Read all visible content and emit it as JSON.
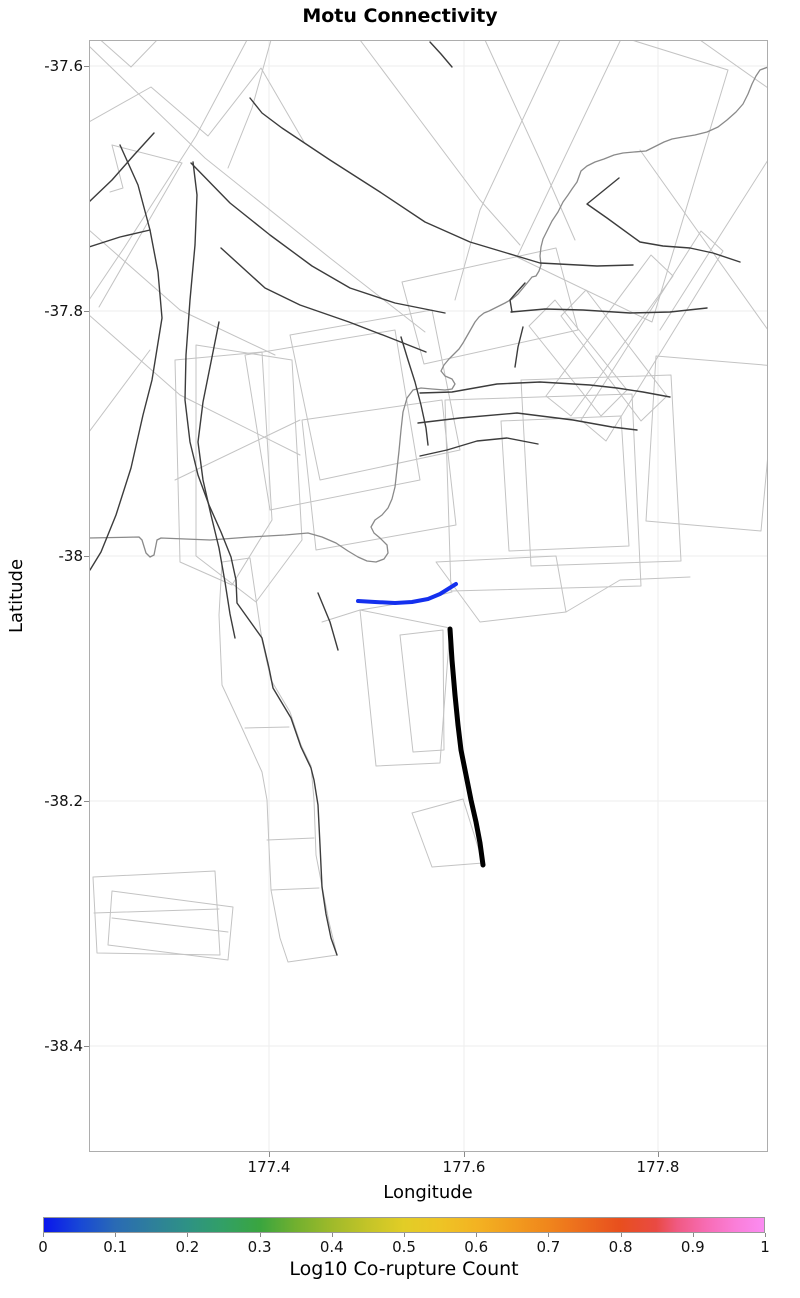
{
  "title": "Motu Connectivity",
  "axes": {
    "xlabel": "Longitude",
    "ylabel": "Latitude",
    "x_ticks": [
      {
        "label": "177.4",
        "px": 269
      },
      {
        "label": "177.6",
        "px": 464
      },
      {
        "label": "177.8",
        "px": 658
      }
    ],
    "y_ticks": [
      {
        "label": "-37.6",
        "px": 66
      },
      {
        "label": "-37.8",
        "px": 311
      },
      {
        "label": "-38",
        "px": 556
      },
      {
        "label": "-38.2",
        "px": 801
      },
      {
        "label": "-38.4",
        "px": 1046
      }
    ]
  },
  "colorbar": {
    "label": "Log10 Co-rupture Count",
    "tick_labels": [
      "0",
      "0.1",
      "0.2",
      "0.3",
      "0.4",
      "0.5",
      "0.6",
      "0.7",
      "0.8",
      "0.9",
      "1"
    ],
    "tick_fractions": [
      0,
      0.1,
      0.2,
      0.3,
      0.4,
      0.5,
      0.6,
      0.7,
      0.8,
      0.9,
      1
    ],
    "range": [
      0,
      1
    ],
    "gradient_stops": [
      {
        "f": 0.0,
        "c": "#0a16ec"
      },
      {
        "f": 0.05,
        "c": "#1848d6"
      },
      {
        "f": 0.1,
        "c": "#2a6bb4"
      },
      {
        "f": 0.15,
        "c": "#2e7f9b"
      },
      {
        "f": 0.2,
        "c": "#2e9284"
      },
      {
        "f": 0.25,
        "c": "#32a065"
      },
      {
        "f": 0.3,
        "c": "#3aa53f"
      },
      {
        "f": 0.35,
        "c": "#72b02f"
      },
      {
        "f": 0.4,
        "c": "#9fba2a"
      },
      {
        "f": 0.45,
        "c": "#c4c428"
      },
      {
        "f": 0.5,
        "c": "#e2cd26"
      },
      {
        "f": 0.55,
        "c": "#eec425"
      },
      {
        "f": 0.6,
        "c": "#f3b322"
      },
      {
        "f": 0.65,
        "c": "#f29d1e"
      },
      {
        "f": 0.7,
        "c": "#f0861c"
      },
      {
        "f": 0.75,
        "c": "#ec6a1d"
      },
      {
        "f": 0.8,
        "c": "#e84f1e"
      },
      {
        "f": 0.85,
        "c": "#e94a43"
      },
      {
        "f": 0.88,
        "c": "#f05a83"
      },
      {
        "f": 0.92,
        "c": "#f76cb4"
      },
      {
        "f": 0.96,
        "c": "#fa7ed8"
      },
      {
        "f": 1.0,
        "c": "#fb8cf2"
      }
    ]
  },
  "chart_data": {
    "type": "map",
    "title": "Motu Connectivity",
    "xlabel": "Longitude",
    "ylabel": "Latitude",
    "lon_range": [
      177.22,
      177.91
    ],
    "lat_range": [
      -38.49,
      -37.58
    ],
    "grid": true,
    "plot_px": {
      "left": 89,
      "top": 40,
      "width": 679,
      "height": 1112
    },
    "calibration": {
      "lon_177_4_px": 269,
      "lon_177_6_px": 464,
      "lat_m37_6_px": 66,
      "lat_m38_px": 556
    },
    "styles": {
      "polygon": {
        "stroke": "#c3c3c3",
        "width": 1.0
      },
      "faint": {
        "stroke": "#c3c3c3",
        "width": 1.0
      },
      "coast": {
        "stroke": "#8a8a8a",
        "width": 1.3
      },
      "trace": {
        "stroke": "#3c3c3c",
        "width": 1.4
      },
      "highlight_min": {
        "stroke": "#1430ee",
        "width": 4.0
      },
      "highlight_bold": {
        "stroke": "#000000",
        "width": 5.0
      }
    },
    "gridline_color": "#ededed",
    "polygons": [
      [
        622,
        37,
        728,
        70,
        652,
        322,
        517,
        257
      ],
      [
        175,
        360,
        262,
        352,
        272,
        520,
        232,
        585,
        180,
        562
      ],
      [
        196,
        345,
        292,
        360,
        302,
        540,
        256,
        602,
        196,
        556
      ],
      [
        245,
        355,
        395,
        330,
        420,
        480,
        270,
        510
      ],
      [
        290,
        335,
        432,
        310,
        460,
        450,
        320,
        480
      ],
      [
        302,
        420,
        442,
        400,
        456,
        525,
        316,
        550
      ],
      [
        555,
        300,
        627,
        390,
        601,
        416,
        529,
        326
      ],
      [
        586,
        290,
        667,
        396,
        641,
        421,
        561,
        316
      ],
      [
        651,
        255,
        546,
        396,
        571,
        416,
        673,
        276
      ],
      [
        701,
        231,
        581,
        420,
        606,
        441,
        723,
        251
      ],
      [
        445,
        400,
        632,
        394,
        641,
        586,
        451,
        591
      ],
      [
        521,
        380,
        671,
        375,
        681,
        561,
        531,
        566
      ],
      [
        501,
        421,
        621,
        416,
        629,
        546,
        509,
        551
      ],
      [
        656,
        356,
        776,
        366,
        761,
        531,
        646,
        521
      ],
      [
        402,
        282,
        556,
        248,
        578,
        330,
        424,
        364
      ],
      [
        360,
        610,
        450,
        628,
        440,
        763,
        376,
        766
      ],
      [
        400,
        635,
        443,
        630,
        444,
        750,
        413,
        752
      ],
      [
        412,
        813,
        463,
        799,
        483,
        863,
        432,
        867
      ],
      [
        93,
        877,
        215,
        871,
        220,
        955,
        97,
        953
      ],
      [
        112,
        891,
        233,
        907,
        228,
        960,
        108,
        945
      ],
      [
        222,
        562,
        250,
        558,
        262,
        640,
        271,
        680,
        290,
        712,
        301,
        745,
        311,
        766,
        314,
        800,
        316,
        855,
        329,
        922,
        337,
        955,
        288,
        962,
        280,
        938,
        271,
        890,
        269,
        847,
        267,
        800,
        262,
        772,
        242,
        728,
        222,
        685,
        219,
        615
      ],
      [
        436,
        562,
        556,
        556,
        566,
        612,
        480,
        622
      ]
    ],
    "faint_lines": [
      [
        96,
        36,
        131,
        67,
        215,
        -20
      ],
      [
        89,
        122,
        151,
        87,
        208,
        136,
        261,
        68,
        304,
        142
      ],
      [
        89,
        46,
        205,
        158,
        330,
        258,
        425,
        332
      ],
      [
        247,
        40,
        196,
        136,
        124,
        248,
        89,
        300
      ],
      [
        271,
        40,
        252,
        108,
        228,
        168
      ],
      [
        360,
        40,
        420,
        120,
        480,
        200,
        520,
        245
      ],
      [
        560,
        40,
        480,
        210,
        455,
        300
      ],
      [
        89,
        315,
        180,
        395,
        300,
        455
      ],
      [
        89,
        432,
        150,
        350
      ],
      [
        175,
        480,
        300,
        420
      ],
      [
        700,
        40,
        768,
        88
      ],
      [
        640,
        150,
        768,
        330
      ],
      [
        768,
        160,
        660,
        330
      ],
      [
        485,
        40,
        540,
        160,
        575,
        240
      ],
      [
        94,
        913,
        219,
        909
      ],
      [
        112,
        918,
        228,
        932
      ],
      [
        245,
        728,
        289,
        727
      ],
      [
        267,
        840,
        314,
        838
      ],
      [
        271,
        890,
        319,
        888
      ],
      [
        322,
        622,
        360,
        610,
        420,
        600,
        452,
        592
      ],
      [
        566,
        612,
        620,
        580,
        690,
        577
      ],
      [
        112,
        145,
        182,
        163
      ],
      [
        112,
        145,
        123,
        188,
        110,
        192
      ],
      [
        182,
        163,
        99,
        307
      ],
      [
        89,
        230,
        180,
        310,
        275,
        355
      ]
    ],
    "coast": [
      89,
      538,
      139,
      537,
      142,
      540,
      146,
      553,
      150,
      557,
      154,
      555,
      157,
      540,
      161,
      538,
      210,
      540,
      250,
      537,
      285,
      535,
      308,
      533,
      322,
      537,
      336,
      543,
      348,
      551,
      358,
      557,
      367,
      561,
      376,
      562,
      384,
      559,
      388,
      553,
      387,
      545,
      380,
      538,
      374,
      533,
      371,
      527,
      375,
      520,
      382,
      515,
      388,
      508,
      392,
      499,
      395,
      487,
      397,
      469,
      399,
      451,
      401,
      430,
      403,
      412,
      407,
      398,
      413,
      390,
      421,
      388,
      432,
      389,
      445,
      390,
      452,
      389,
      455,
      384,
      452,
      379,
      445,
      376,
      441,
      371,
      444,
      365,
      449,
      359,
      454,
      354,
      459,
      349,
      463,
      343,
      467,
      336,
      471,
      329,
      475,
      322,
      479,
      317,
      484,
      313,
      489,
      311,
      497,
      307,
      505,
      303,
      512,
      299,
      518,
      294,
      523,
      288,
      528,
      282,
      532,
      277,
      536,
      276,
      539,
      271,
      541,
      265,
      540,
      256,
      541,
      247,
      543,
      239,
      547,
      231,
      552,
      221,
      558,
      212,
      563,
      202,
      568,
      195,
      572,
      189,
      577,
      182,
      581,
      171,
      587,
      166,
      595,
      162,
      604,
      159,
      614,
      155,
      623,
      153,
      634,
      152,
      646,
      151,
      656,
      146,
      664,
      142,
      672,
      139,
      683,
      137,
      695,
      135,
      707,
      132,
      718,
      127,
      727,
      120,
      736,
      112,
      743,
      104,
      748,
      94,
      752,
      84,
      756,
      76,
      760,
      70,
      768,
      67
    ],
    "traces": [
      [
        250,
        98,
        262,
        113,
        282,
        128,
        330,
        160,
        380,
        192,
        425,
        222,
        470,
        242,
        540,
        263,
        597,
        266,
        633,
        265
      ],
      [
        619,
        178,
        587,
        204,
        607,
        218,
        640,
        242,
        663,
        246,
        690,
        248,
        713,
        253,
        740,
        262
      ],
      [
        511,
        312,
        545,
        309,
        583,
        310,
        630,
        313,
        670,
        312,
        707,
        308
      ],
      [
        525,
        283,
        516,
        293,
        510,
        300,
        512,
        312
      ],
      [
        523,
        327,
        518,
        347,
        515,
        367
      ],
      [
        191,
        163,
        230,
        203,
        270,
        235,
        312,
        266,
        350,
        288,
        395,
        303,
        430,
        310,
        445,
        313
      ],
      [
        89,
        202,
        112,
        180,
        134,
        155,
        154,
        133
      ],
      [
        120,
        145,
        138,
        185,
        150,
        230,
        158,
        272,
        162,
        318,
        152,
        380,
        143,
        415,
        131,
        468,
        116,
        515,
        101,
        552,
        90,
        570
      ],
      [
        193,
        162,
        197,
        195,
        195,
        245,
        190,
        300,
        186,
        355,
        185,
        400,
        190,
        442,
        198,
        475,
        209,
        505,
        221,
        532,
        231,
        557,
        236,
        580,
        237,
        603,
        262,
        638,
        269,
        668,
        273,
        688,
        291,
        718,
        301,
        747,
        311,
        768,
        314,
        780,
        318,
        805,
        320,
        845,
        322,
        887,
        326,
        914,
        331,
        938,
        337,
        955
      ],
      [
        219,
        322,
        211,
        362,
        203,
        402,
        198,
        442,
        203,
        480,
        211,
        515,
        219,
        548,
        225,
        582,
        230,
        614,
        235,
        638
      ],
      [
        221,
        248,
        265,
        288,
        300,
        305,
        349,
        322,
        388,
        337,
        426,
        352
      ],
      [
        420,
        393,
        452,
        392,
        497,
        384,
        540,
        382,
        590,
        385,
        617,
        388,
        643,
        392,
        670,
        397
      ],
      [
        418,
        423,
        460,
        418,
        517,
        413,
        573,
        420,
        612,
        427,
        637,
        430
      ],
      [
        420,
        456,
        447,
        450,
        477,
        441,
        507,
        438,
        538,
        444
      ],
      [
        401,
        337,
        408,
        360,
        415,
        382,
        421,
        405,
        426,
        428,
        428,
        445
      ],
      [
        318,
        593,
        330,
        622,
        338,
        650
      ],
      [
        89,
        247,
        120,
        237,
        150,
        230
      ],
      [
        430,
        42,
        441,
        54,
        452,
        67
      ]
    ],
    "highlights": [
      {
        "name": "co-rupture-min-line",
        "style": "highlight_min",
        "points": [
          358,
          601,
          375,
          602,
          395,
          603,
          412,
          602,
          428,
          599,
          440,
          594,
          448,
          589,
          456,
          584
        ]
      },
      {
        "name": "bold-fault-line",
        "style": "highlight_bold",
        "points": [
          450,
          629,
          452,
          660,
          455,
          695,
          458,
          725,
          461,
          750,
          466,
          775,
          471,
          800,
          476,
          822,
          480,
          843,
          483,
          865
        ]
      }
    ]
  }
}
